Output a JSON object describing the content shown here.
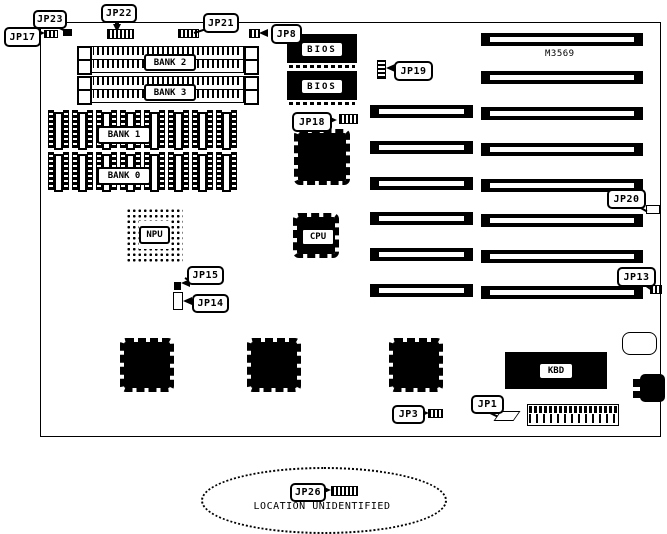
{
  "diagram": {
    "model": "M3569",
    "unidentified_caption": "LOCATION UNIDENTIFIED"
  },
  "callouts": {
    "jp1": "JP1",
    "jp3": "JP3",
    "jp8": "JP8",
    "jp13": "JP13",
    "jp14": "JP14",
    "jp15": "JP15",
    "jp17": "JP17",
    "jp18": "JP18",
    "jp19": "JP19",
    "jp20": "JP20",
    "jp21": "JP21",
    "jp22": "JP22",
    "jp23": "JP23",
    "jp26": "JP26"
  },
  "components": {
    "bank0": "BANK 0",
    "bank1": "BANK 1",
    "bank2": "BANK 2",
    "bank3": "BANK 3",
    "bios_top": "BIOS",
    "bios_bottom": "BIOS",
    "npu": "NPU",
    "cpu": "CPU",
    "kbd": "KBD"
  },
  "colors": {
    "ink": "#000000",
    "paper": "#ffffff"
  }
}
